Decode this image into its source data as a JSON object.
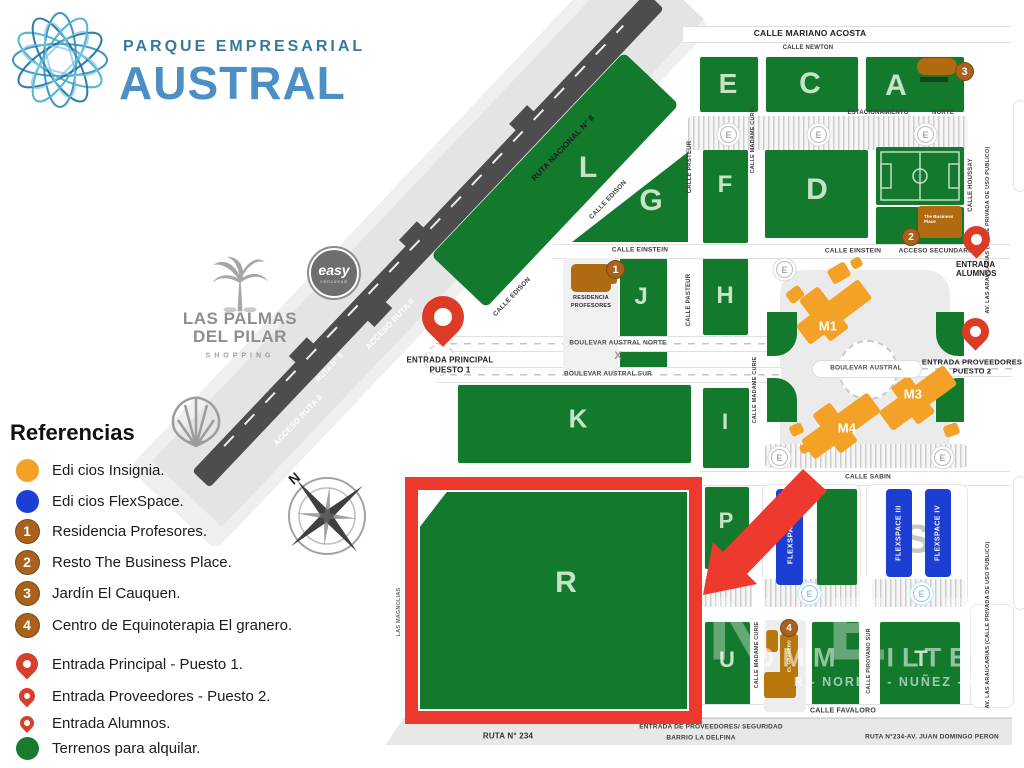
{
  "logo": {
    "line1": "PARQUE EMPRESARIAL",
    "line2": "AUSTRAL"
  },
  "legend": {
    "title": "Referencias",
    "items": [
      {
        "label": "Edi cios Insignia."
      },
      {
        "label": "Edi cios FlexSpace."
      },
      {
        "badge": "1",
        "label": "Residencia Profesores."
      },
      {
        "badge": "2",
        "label": "Resto The Business Place."
      },
      {
        "badge": "3",
        "label": "Jardín El Cauquen."
      },
      {
        "badge": "4",
        "label": "Centro de Equinoterapia El granero."
      },
      {
        "label": "Entrada Principal - Puesto 1."
      },
      {
        "label": "Entrada Proveedores - Puesto 2."
      },
      {
        "label": "Entrada Alumnos."
      },
      {
        "label": "Terrenos para alquilar."
      }
    ]
  },
  "landmarks": {
    "shopping": {
      "line1": "LAS PALMAS",
      "line2": "DEL PILAR",
      "sub": "SHOPPING"
    },
    "easy": {
      "name": "easy",
      "sub": "cencosud"
    }
  },
  "map": {
    "compass": "N",
    "parking": {
      "e": "E",
      "estacionamiento": "ESTACIONAMIENTO",
      "norte": "NORTE"
    },
    "streets": {
      "mariano_acosta": "CALLE MARIANO ACOSTA",
      "newton": "CALLE NEWTON",
      "pasteur": "CALLE PASTEUR",
      "madame_curie": "CALLE MADAME CURIE",
      "houssay": "CALLE HOUSSAY",
      "araucarias": "AV. LAS ARAUCARIAS (CALLE PRIVADA DE USO PUBLICO)",
      "edison": "CALLE EDISON",
      "einstein": "CALLE EINSTEIN",
      "acceso_secundario": "ACCESO SECUNDARIO",
      "boulevar_norte": "BOULEVAR AUSTRAL NORTE",
      "boulevar_sur": "BOULEVAR AUSTRAL SUR",
      "boulevar": "BOULEVAR AUSTRAL",
      "sabin": "CALLE SABIN",
      "pirovano_sur": "CALLE PIROVANO SUR",
      "favaloro": "CALLE FAVALORO",
      "magnolias": "LAS MAGNOLIAS",
      "ruta_nacional_8": "RUTA NACIONAL N° 8",
      "acceso_ruta_8": "ACCESO RUTA 8",
      "ruta_8": "RUTA N° 8",
      "ruta_234": "RUTA N° 234",
      "ruta_234_peron": "RUTA N°234-AV. JUAN DOMINGO PERON",
      "entrada_seguridad": "ENTRADA DE PROVEEDORES/ SEGURIDAD",
      "barrio": "BARRIO LA DELFINA",
      "x_mark": "X"
    },
    "blocks": {
      "e": "E",
      "c": "C",
      "a": "A",
      "l": "L",
      "g": "G",
      "f": "F",
      "d": "D",
      "j": "J",
      "h": "H",
      "k": "K",
      "i": "I",
      "r": "R",
      "p": "P",
      "n": "N",
      "s": "S",
      "u": "U",
      "t": "T"
    },
    "buildings": {
      "m1": "M1",
      "m3": "M3",
      "m4": "M4",
      "flexspace1": "FLEXSPACE I",
      "flexspace3": "FLEXSPACE III",
      "flexspace4": "FLEXSPACE IV",
      "residencia_l1": "RESIDENCIA",
      "residencia_l2": "PROFESORES",
      "business_place": "The Business Place",
      "granero": "EL GRANERO"
    },
    "badges": {
      "b1": "1",
      "b2": "2",
      "b3": "3",
      "b4": "4"
    },
    "pins": {
      "principal_l1": "ENTRADA PRINCIPAL",
      "principal_l2": "PUESTO 1",
      "proveedores_l1": "ENTRADA PROVEEDORES",
      "proveedores_l2": "PUESTO 2",
      "alumnos": "ENTRADA ALUMNOS"
    },
    "watermark": {
      "big": "NET",
      "line1": "OMM BILTER",
      "line2": "R - NORE A - NUÑEZ - D"
    }
  },
  "colors": {
    "block_green": "#137a2d",
    "insignia_orange": "#f4a127",
    "campus_brown": "#b06a10",
    "flexspace_blue": "#1d3ed3",
    "pin_red": "#dc3b25",
    "highlight_red": "#ee3a2e",
    "road_dark": "#4d4d4d"
  }
}
